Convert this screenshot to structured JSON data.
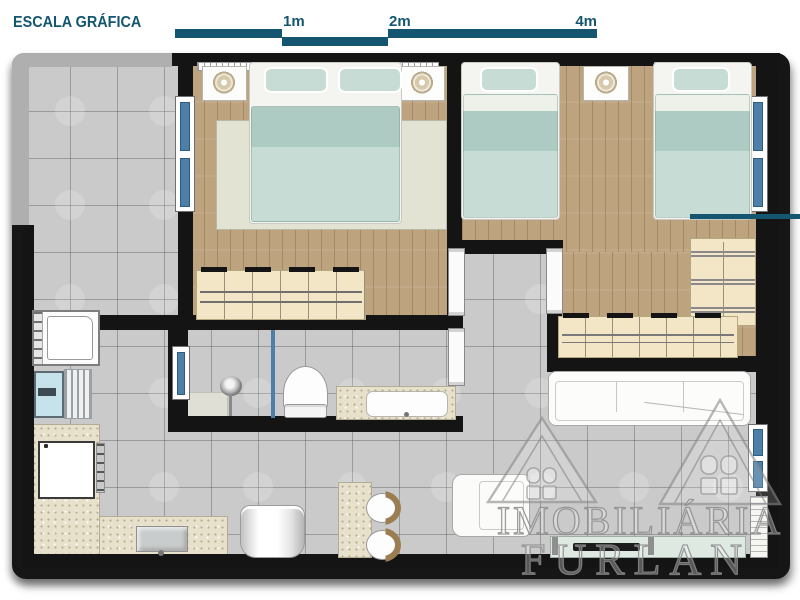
{
  "scale_bar": {
    "title": "ESCALA GRÁFICA",
    "labels": {
      "m1": "1m",
      "m2": "2m",
      "m4": "4m"
    }
  },
  "watermark": {
    "line1": "IMOBILIÁRIA",
    "line2": "FURLAN"
  },
  "colors": {
    "accent": "#14566F",
    "wall": "#141414",
    "wood": "#BEA37F",
    "tile": "#C9CAC9",
    "bed": "#C6DCD5",
    "bed_dark": "#AECBC3",
    "granite": "#E7E0CB",
    "closet": "#F2E6C6",
    "windowglass": "#4E7FA8",
    "waterblue": "#C6E3EC",
    "rug": "#E2E3D3",
    "gray_band": "#AFAFAF",
    "glass_shelf": "#DEE9E2",
    "watermark_stroke": "#8D8D8D"
  }
}
